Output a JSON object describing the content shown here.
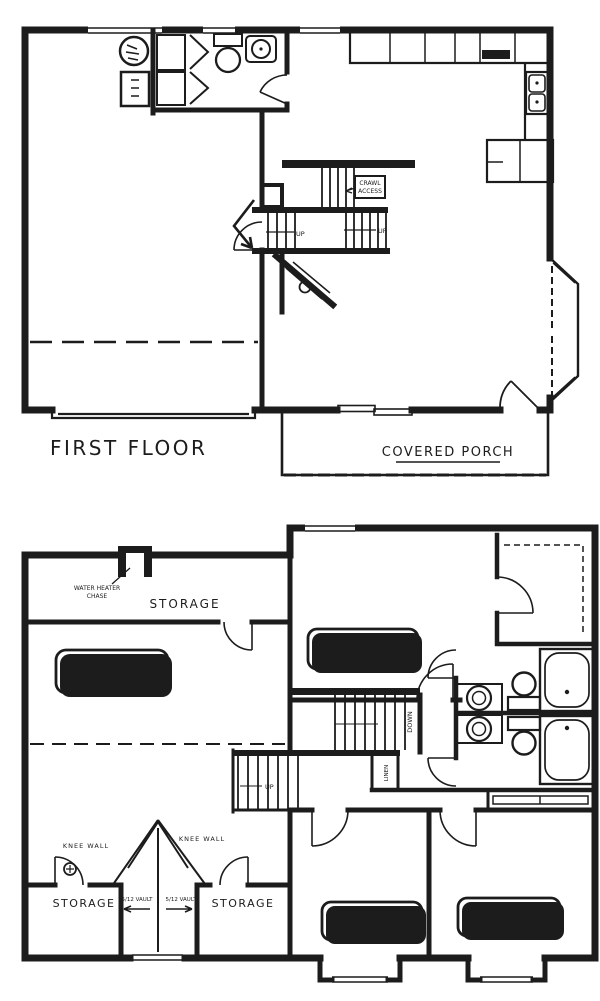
{
  "colors": {
    "ink": "#1c1c1c",
    "paper": "#ffffff"
  },
  "first_floor": {
    "title": "FIRST FLOOR",
    "porch": "COVERED PORCH",
    "crawl1": "CRAWL",
    "crawl2": "ACCESS",
    "up": "UP"
  },
  "second_floor": {
    "storage_top": "STORAGE",
    "wh1": "WATER HEATER",
    "wh2": "CHASE",
    "bonus_name": "BONUS ROOM",
    "bonus_dims": "19'-4\" x 19'-0\"",
    "mbr_name": "M BEDROOM",
    "mbr_dims": "14'-8\" x 12'-3\"",
    "b3_name": "BEDROOM 3",
    "b3_dims": "10'-0\" x 10'-0\"",
    "b2_name": "BEDROOM 2",
    "b2_dims": "10'-0\" x 10'-0\"",
    "down": "DOWN",
    "up": "UP",
    "linen": "LINEN",
    "knee1": "KNEE WALL",
    "knee2": "KNEE WALL",
    "vault1": "5/12 VAULT",
    "vault2": "5/12 VAULT",
    "storage_l": "STORAGE",
    "storage_r": "STORAGE"
  }
}
